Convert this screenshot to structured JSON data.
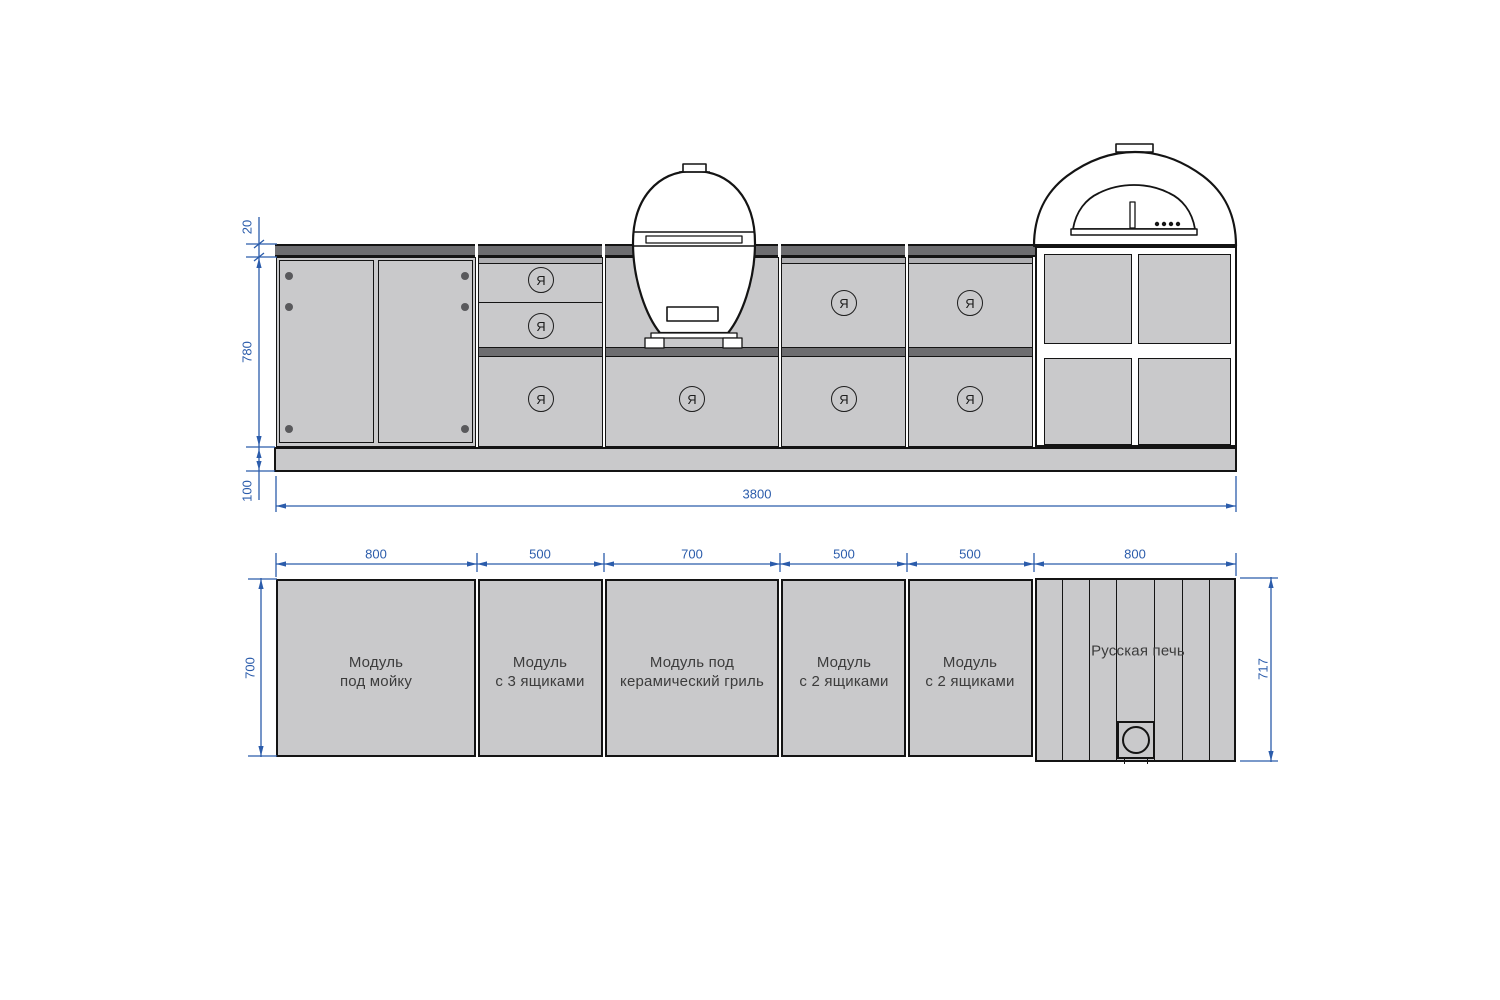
{
  "colors": {
    "dimension_blue": "#2b5cab",
    "module_fill": "#c9c9cb",
    "counter_fill": "#6d6d70",
    "outline": "#141414",
    "label_text": "#3c3c3c"
  },
  "elevation": {
    "dim_countertop_thickness": "20",
    "dim_cabinet_height": "780",
    "dim_plinth_height": "100",
    "dim_total_width": "3800",
    "handle_symbol": "Я"
  },
  "plan": {
    "dim_module_widths": [
      "800",
      "500",
      "700",
      "500",
      "500",
      "800"
    ],
    "dim_depth": "700",
    "dim_stove_depth": "717",
    "modules": [
      {
        "line1": "Модуль",
        "line2": "под мойку"
      },
      {
        "line1": "Модуль",
        "line2": "с 3 ящиками"
      },
      {
        "line1": "Модуль под",
        "line2": "керамический гриль"
      },
      {
        "line1": "Модуль",
        "line2": "с 2 ящиками"
      },
      {
        "line1": "Модуль",
        "line2": "с 2 ящиками"
      },
      {
        "line1": "Русская печь",
        "line2": ""
      }
    ]
  }
}
